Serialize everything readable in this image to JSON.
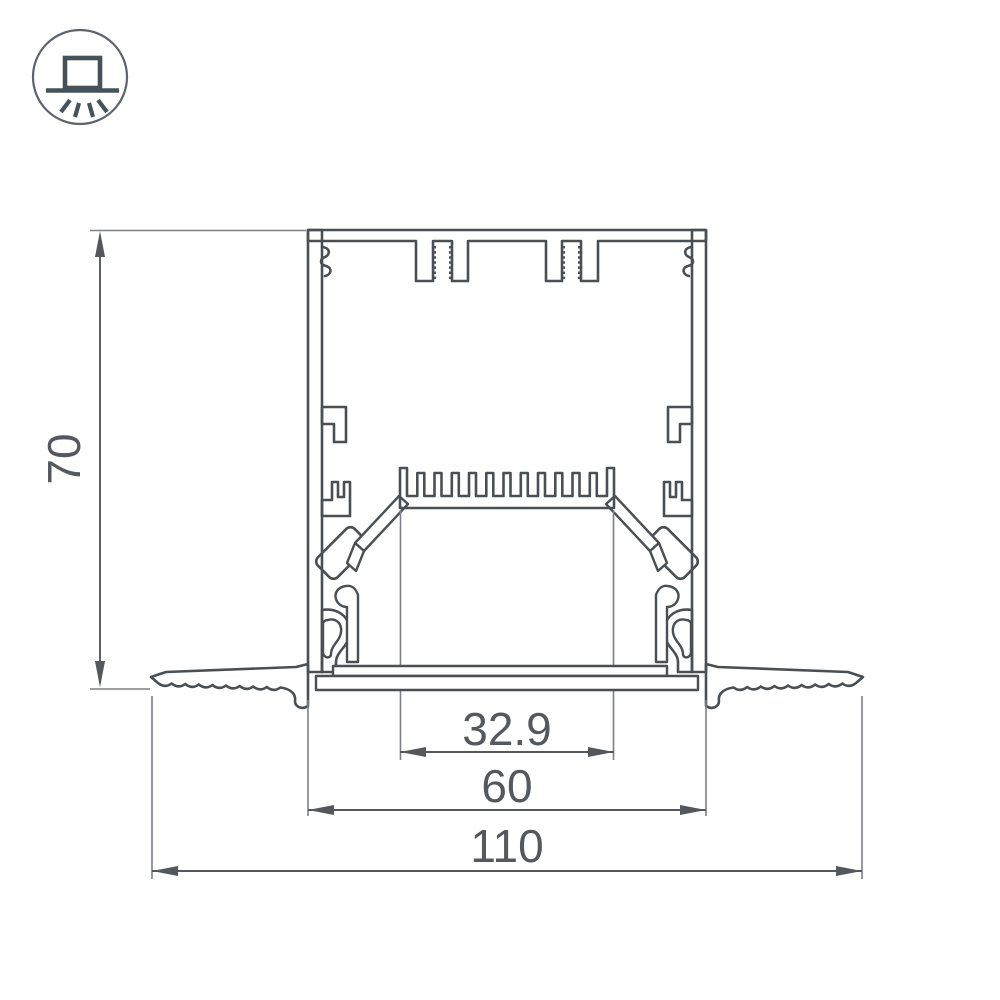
{
  "window": {
    "background": "#ffffff"
  },
  "icon_badge": {
    "name": "recessed-luminaire-icon",
    "meaning": "recessed/built-in mounting light symbol"
  },
  "drawing": {
    "type": "cross-section technical drawing",
    "subject": "Recessed aluminum LED profile with heatsink comb, mounting clamps and trim flanges",
    "units": "mm",
    "dimensions": {
      "height": {
        "label": "70"
      },
      "led_shelf_width": {
        "label": "32.9"
      },
      "body_width": {
        "label": "60"
      },
      "overall_width": {
        "label": "110"
      }
    },
    "colors": {
      "line": "#4a4f54",
      "dim_line": "#54585c",
      "ext_line": "#7d8185",
      "metal_fill": "#e9eaeb",
      "hatch_line": "#878c90",
      "text": "#55595d",
      "icon_stroke": "#46525a",
      "icon_circle": "#5d646b"
    }
  }
}
